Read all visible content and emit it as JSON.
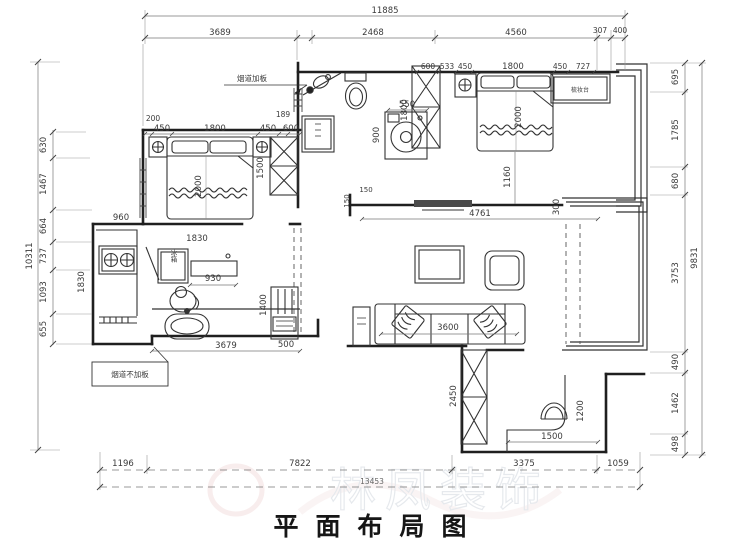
{
  "title": "平面布局图",
  "watermark": "林凤装饰",
  "notes": {
    "flue_add": "烟道加板",
    "flue_none": "烟道不加板"
  },
  "labels": {
    "fridge": "冰箱",
    "dressing_table": "梳妆台"
  },
  "dims": {
    "top_total": "11885",
    "top_1": "3689",
    "top_2": "2468",
    "top_3": "4560",
    "top_4": "307",
    "top_5": "400",
    "left_total": "10311",
    "left_1": "630",
    "left_2": "1467",
    "left_3": "664",
    "left_4": "737",
    "left_5": "1093",
    "left_6": "655",
    "right_total": "9831",
    "right_1": "695",
    "right_2": "1785",
    "right_3": "680",
    "right_4": "3753",
    "right_5": "490",
    "right_6": "1462",
    "right_7": "498",
    "bottom_total": "13453",
    "bottom_1": "1196",
    "bottom_2": "7822",
    "bottom_3": "3375",
    "bottom_4": "1059",
    "bed1_200": "200",
    "bed1_450a": "450",
    "bed1_1800": "1800",
    "bed1_450b": "450",
    "bed1_189": "189",
    "bed1_600": "600",
    "bed1_1500": "1500",
    "bed1_2000": "2000",
    "kitchen_960": "960",
    "kitchen_1830h": "1830",
    "kitchen_1830v": "1830",
    "kitchen_930": "930",
    "bath1_3679": "3679",
    "bath1_1400": "1400",
    "bath1_500": "500",
    "bath2_550": "550",
    "bath2_900": "900",
    "bed2_600": "600",
    "bed2_533": "533",
    "bed2_450a": "450",
    "bed2_1800": "1800",
    "bed2_450b": "450",
    "bed2_727": "727",
    "bed2_1800v": "1800",
    "bed2_2000": "2000",
    "bed2_1160": "1160",
    "living_150a": "150",
    "living_150b": "150",
    "living_4761": "4761",
    "living_300": "300",
    "living_3600": "3600",
    "room2_2450": "2450",
    "room2_1500": "1500",
    "room2_1200": "1200"
  }
}
